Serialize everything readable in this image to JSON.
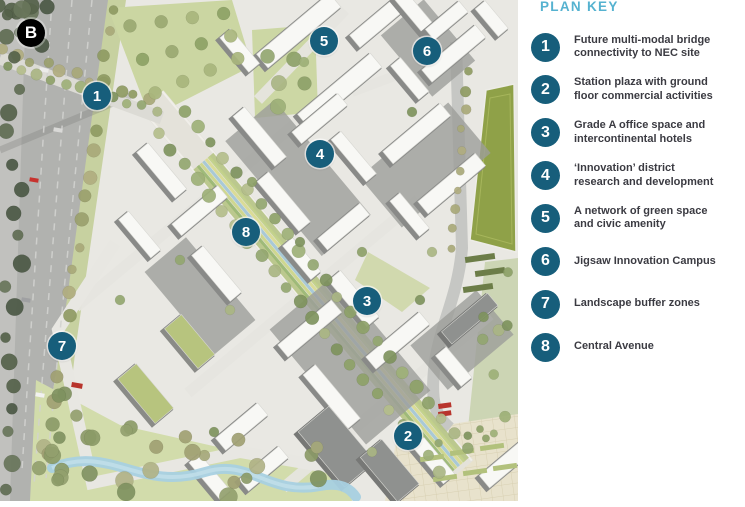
{
  "map": {
    "badge_label": "B",
    "markers": [
      {
        "n": "1",
        "x": 97,
        "y": 96
      },
      {
        "n": "2",
        "x": 408,
        "y": 436
      },
      {
        "n": "3",
        "x": 367,
        "y": 301
      },
      {
        "n": "4",
        "x": 320,
        "y": 154
      },
      {
        "n": "5",
        "x": 324,
        "y": 41
      },
      {
        "n": "6",
        "x": 427,
        "y": 51
      },
      {
        "n": "7",
        "x": 62,
        "y": 346
      },
      {
        "n": "8",
        "x": 246,
        "y": 232
      }
    ]
  },
  "legend": {
    "title": "PLAN KEY",
    "items": [
      {
        "n": "1",
        "label": "Future multi-modal bridge\nconnectivity to NEC site"
      },
      {
        "n": "2",
        "label": "Station plaza with ground\nfloor commercial activities"
      },
      {
        "n": "3",
        "label": "Grade A office space and\nintercontinental hotels"
      },
      {
        "n": "4",
        "label": "‘Innovation’ district\nresearch and development"
      },
      {
        "n": "5",
        "label": "A network of green space\nand civic amenity"
      },
      {
        "n": "6",
        "label": "Jigsaw Innovation Campus"
      },
      {
        "n": "7",
        "label": "Landscape buffer zones"
      },
      {
        "n": "8",
        "label": "Central Avenue"
      }
    ]
  },
  "colors": {
    "plan_key_title": "#55b2d0",
    "key_circle": "#175e7b",
    "key_text": "#3b3b42",
    "map_marker": "#175e7b",
    "badge": "#000000"
  }
}
